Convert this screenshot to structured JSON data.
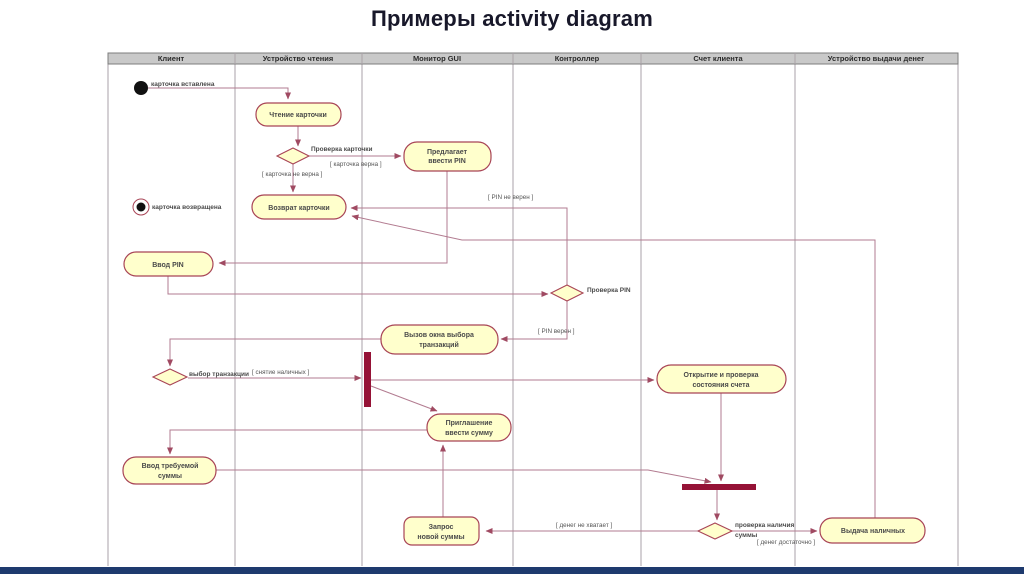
{
  "title": "Примеры activity diagram",
  "swimlanes": [
    "Клиент",
    "Устройство чтения",
    "Монитор GUI",
    "Контроллер",
    "Счет клиента",
    "Устройство выдачи денег"
  ],
  "nodes": {
    "card_inserted": "карточка вставлена",
    "read_card": "Чтение карточки",
    "check_card_label": "Проверка карточки",
    "offer_pin": {
      "line1": "Предлагает",
      "line2": "ввести PIN"
    },
    "return_card": "Возврат карточки",
    "card_returned": "карточка возвращена",
    "enter_pin": "Ввод PIN",
    "check_pin_label": "Проверка PIN",
    "call_window": {
      "line1": "Вызов окна выбора",
      "line2": "транзакций"
    },
    "choose_transaction_label": "выбор транзакции",
    "open_check_account": {
      "line1": "Открытие и проверка",
      "line2": "состояния счета"
    },
    "invite_amount": {
      "line1": "Приглашение",
      "line2": "ввести сумму"
    },
    "enter_amount": {
      "line1": "Ввод требуемой",
      "line2": "суммы"
    },
    "request_new_amount": {
      "line1": "Запрос",
      "line2": "новой суммы"
    },
    "check_availability_label": {
      "line1": "проверка наличия",
      "line2": "суммы"
    },
    "dispense_cash": "Выдача наличных"
  },
  "guards": {
    "card_valid": "[ карточка верна ]",
    "card_invalid": "[ карточка не верна ]",
    "pin_invalid": "[ PIN не верен ]",
    "pin_valid": "[ PIN верен ]",
    "withdraw_cash": "[ снятие наличных ]",
    "not_enough_money": "[ денег не хватает ]",
    "enough_money": "[ денег достаточно ]"
  },
  "colors": {
    "activity_fill": "#ffffcc",
    "activity_border": "#a84456",
    "edge": "#b27b90",
    "sync_bar": "#951236",
    "header_fill": "#c9c9c9",
    "footer_bar": "#1e3a6e"
  }
}
